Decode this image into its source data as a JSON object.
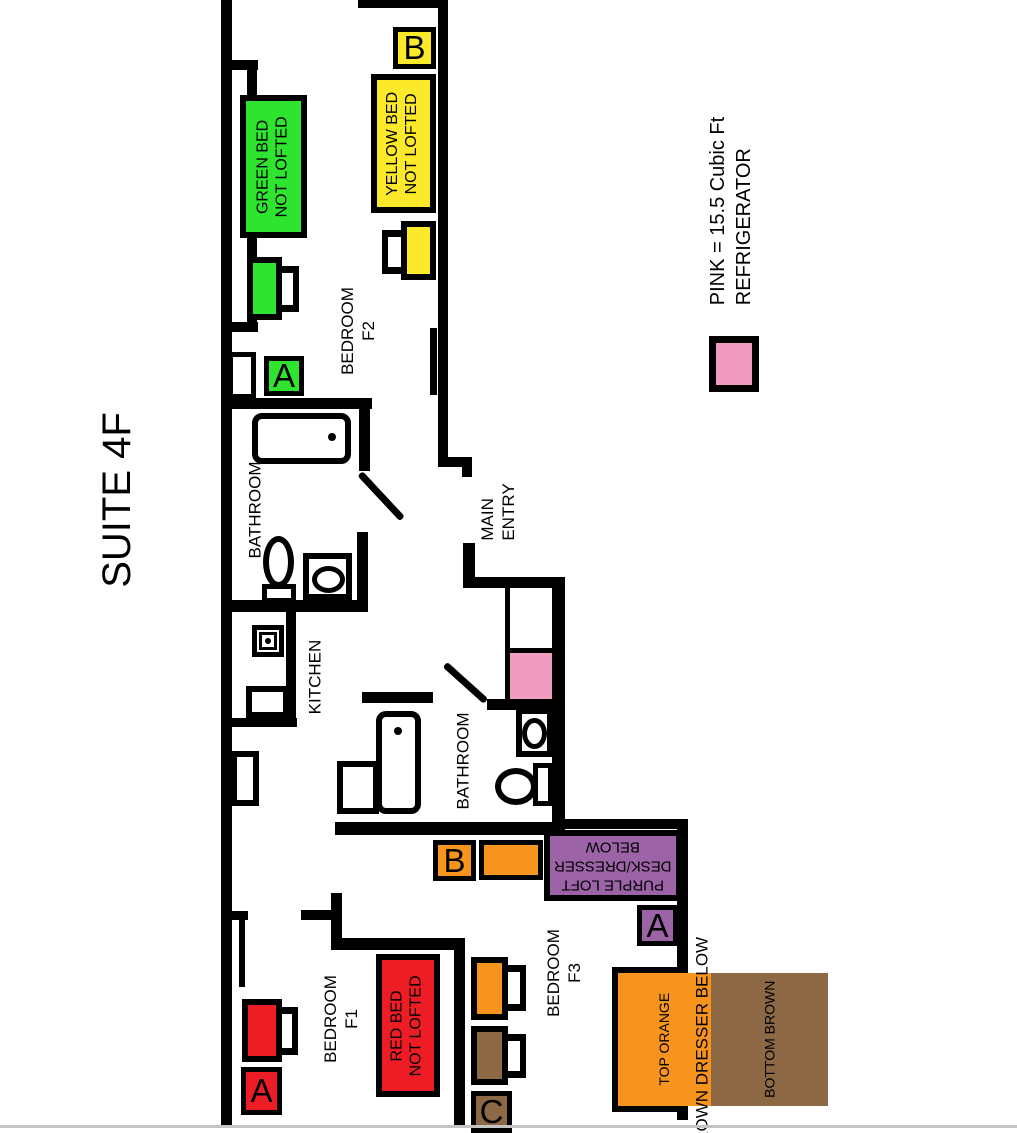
{
  "title": "SUITE 4F",
  "legend": {
    "line1": "PINK = 15.5 Cubic Ft",
    "line2": "REFRIGERATOR"
  },
  "rooms": {
    "bedroom_f2": {
      "line1": "BEDROOM",
      "line2": "F2"
    },
    "bathroom_top": {
      "label": "BATHROOM"
    },
    "kitchen": {
      "label": "KITCHEN"
    },
    "main_entry": {
      "line1": "MAIN",
      "line2": "ENTRY"
    },
    "bathroom_bottom": {
      "label": "BATHROOM"
    },
    "bedroom_f1": {
      "line1": "BEDROOM",
      "line2": "F1"
    },
    "bedroom_f3": {
      "line1": "BEDROOM",
      "line2": "F3"
    }
  },
  "furniture": {
    "green_bed": {
      "line1": "GREEN BED",
      "line2": "NOT LOFTED"
    },
    "yellow_bed": {
      "line1": "YELLOW BED",
      "line2": "NOT LOFTED"
    },
    "red_bed": {
      "line1": "RED BED",
      "line2": "NOT LOFTED"
    },
    "purple_loft": {
      "line1": "PURPLE LOFT",
      "line2": "DESK/DRESSER",
      "line3": "BELOW"
    },
    "orange_brown_unit": {
      "line1": "TOP ORANGE",
      "line2": "BOTTOM BROWN"
    },
    "brown_dresser_note": "BROWN DRESSER BELOW"
  },
  "position_labels": {
    "f2_green_a": "A",
    "f2_yellow_b": "B",
    "f1_red_a": "A",
    "f3_orange_b": "B",
    "f3_purple_a": "A",
    "f3_brown_c": "C"
  },
  "colors": {
    "green": "#2ee42e",
    "yellow": "#fbe92a",
    "red": "#ee1c25",
    "orange": "#f7941e",
    "brown": "#8c6845",
    "purple": "#9c63a7",
    "pink": "#f09bc0",
    "wall": "#000000",
    "page_edge": "#c4c4c4"
  }
}
